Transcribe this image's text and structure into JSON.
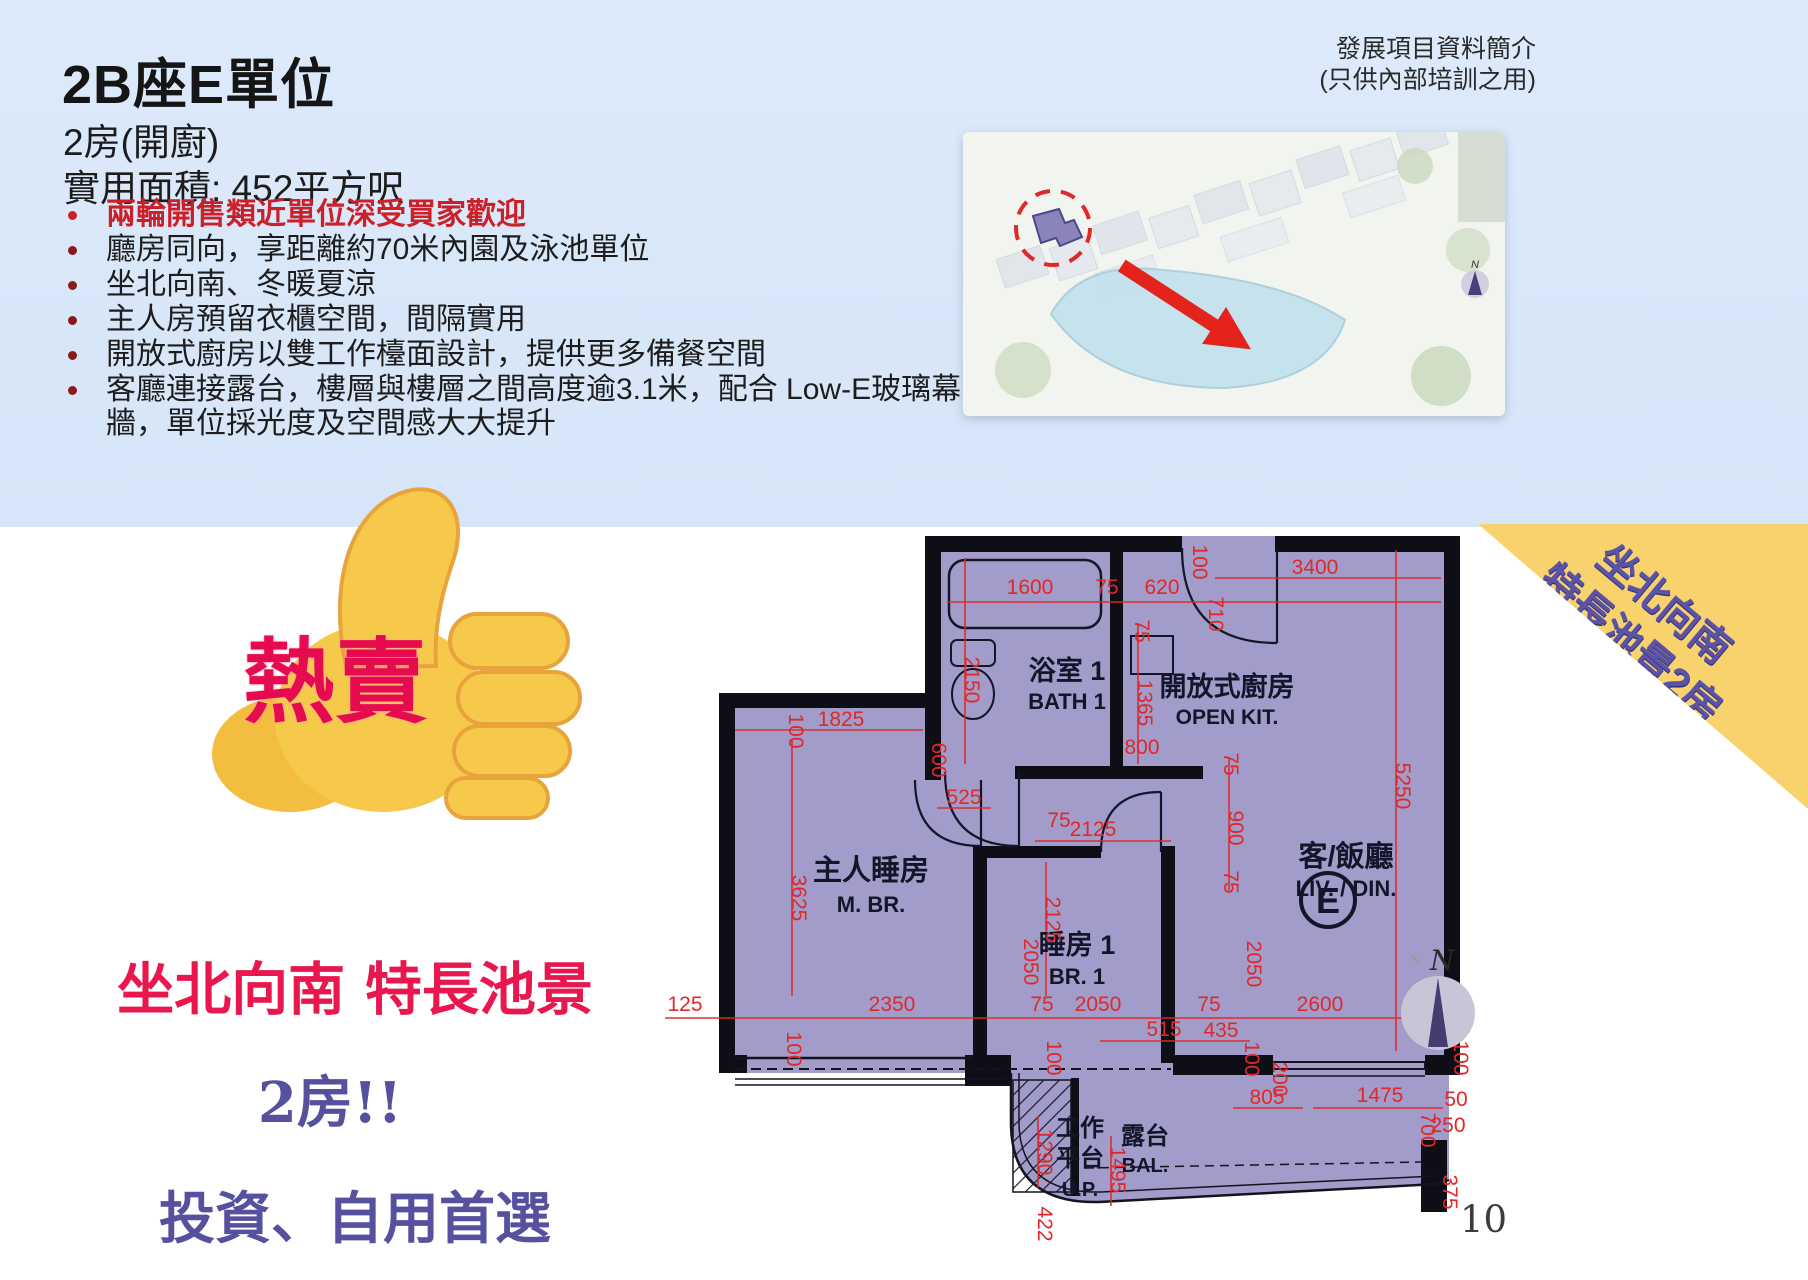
{
  "slide": {
    "title": "2B座E單位",
    "subtitle": "2房(開廚)",
    "area_line": "實用面積: 452平方呎",
    "corner_note_line1": "發展項目資料簡介",
    "corner_note_line2": "(只供內部培訓之用)",
    "page_number": "10"
  },
  "bullets": [
    {
      "text": "兩輪開售類近單位深受買家歡迎",
      "highlight": true
    },
    {
      "text": "廳房同向，享距離約70米內園及泳池單位",
      "highlight": false
    },
    {
      "text": "坐北向南、冬暖夏涼",
      "highlight": false
    },
    {
      "text": "主人房預留衣櫃空間，間隔實用",
      "highlight": false
    },
    {
      "text": "開放式廚房以雙工作檯面設計，提供更多備餐空間",
      "highlight": false
    },
    {
      "text": "客廳連接露台，樓層與樓層之間高度逾3.1米，配合 Low-E玻璃幕牆，單位採光度及空間感大大提升",
      "highlight": false
    }
  ],
  "promo": {
    "hot_sale": "熱賣",
    "line1": "坐北向南 特長池景",
    "line2": "2房!!",
    "line3": "投資、自用首選"
  },
  "banner": {
    "line1": "坐北向南",
    "line2": "特長池景2房"
  },
  "compass": {
    "north": "N"
  },
  "colors": {
    "band_blue": "#d9e7f8",
    "plan_fill": "#a19cc9",
    "wall_black": "#0e0e16",
    "dim_red": "#e02828",
    "banner_yellow": "#f8d26d",
    "banner_text": "#5b53a6",
    "promo_red": "#e8174d",
    "promo_purple": "#55519e",
    "arrow_red": "#e3231c"
  },
  "floorplan": {
    "unit_label": "E",
    "labels": [
      {
        "t": "浴室 1",
        "x": 452,
        "y": 152,
        "s": 27
      },
      {
        "t": "BATH 1",
        "x": 452,
        "y": 181,
        "s": 22
      },
      {
        "t": "開放式廚房",
        "x": 612,
        "y": 168,
        "s": 27
      },
      {
        "t": "OPEN KIT.",
        "x": 612,
        "y": 196,
        "s": 21
      },
      {
        "t": "客/飯廳",
        "x": 731,
        "y": 338,
        "s": 29
      },
      {
        "t": "LIV. / DIN.",
        "x": 731,
        "y": 368,
        "s": 22
      },
      {
        "t": "主人睡房",
        "x": 256,
        "y": 352,
        "s": 29
      },
      {
        "t": "M. BR.",
        "x": 256,
        "y": 384,
        "s": 22
      },
      {
        "t": "睡房 1",
        "x": 462,
        "y": 426,
        "s": 27
      },
      {
        "t": "BR. 1",
        "x": 462,
        "y": 456,
        "s": 22
      },
      {
        "t": "工作",
        "x": 465,
        "y": 608,
        "s": 24
      },
      {
        "t": "平台",
        "x": 465,
        "y": 638,
        "s": 24
      },
      {
        "t": "U.P.",
        "x": 465,
        "y": 668,
        "s": 20
      },
      {
        "t": "露台",
        "x": 530,
        "y": 616,
        "s": 24
      },
      {
        "t": "BAL.",
        "x": 530,
        "y": 644,
        "s": 20
      }
    ],
    "dimensions": [
      {
        "t": "1600",
        "x": 415,
        "y": 66,
        "r": 0
      },
      {
        "t": "75",
        "x": 492,
        "y": 66,
        "r": 0
      },
      {
        "t": "620",
        "x": 547,
        "y": 66,
        "r": 0
      },
      {
        "t": "3400",
        "x": 700,
        "y": 46,
        "r": 0
      },
      {
        "t": "100",
        "x": 578,
        "y": 34,
        "r": 90
      },
      {
        "t": "710",
        "x": 594,
        "y": 86,
        "r": 90
      },
      {
        "t": "2150",
        "x": 350,
        "y": 152,
        "r": 90
      },
      {
        "t": "75",
        "x": 520,
        "y": 103,
        "r": 90
      },
      {
        "t": "1365",
        "x": 523,
        "y": 175,
        "r": 90
      },
      {
        "t": "1825",
        "x": 226,
        "y": 198,
        "r": 0
      },
      {
        "t": "100",
        "x": 174,
        "y": 203,
        "r": 90
      },
      {
        "t": "600",
        "x": 317,
        "y": 232,
        "r": 90
      },
      {
        "t": "525",
        "x": 349,
        "y": 276,
        "r": 0
      },
      {
        "t": "800",
        "x": 527,
        "y": 226,
        "r": 0
      },
      {
        "t": "75",
        "x": 609,
        "y": 236,
        "r": 90
      },
      {
        "t": "900",
        "x": 614,
        "y": 300,
        "r": 90
      },
      {
        "t": "75",
        "x": 609,
        "y": 354,
        "r": 90
      },
      {
        "t": "5250",
        "x": 781,
        "y": 258,
        "r": 90
      },
      {
        "t": "2125",
        "x": 478,
        "y": 308,
        "r": 0
      },
      {
        "t": "75",
        "x": 444,
        "y": 299,
        "r": 0
      },
      {
        "t": "2125",
        "x": 431,
        "y": 392,
        "r": 90
      },
      {
        "t": "2050",
        "x": 409,
        "y": 434,
        "r": 90
      },
      {
        "t": "2050",
        "x": 632,
        "y": 436,
        "r": 90
      },
      {
        "t": "3625",
        "x": 177,
        "y": 370,
        "r": 90
      },
      {
        "t": "125",
        "x": 70,
        "y": 483,
        "r": 0
      },
      {
        "t": "2350",
        "x": 277,
        "y": 483,
        "r": 0
      },
      {
        "t": "75",
        "x": 427,
        "y": 483,
        "r": 0
      },
      {
        "t": "2050",
        "x": 483,
        "y": 483,
        "r": 0
      },
      {
        "t": "75",
        "x": 594,
        "y": 483,
        "r": 0
      },
      {
        "t": "2600",
        "x": 705,
        "y": 483,
        "r": 0
      },
      {
        "t": "125",
        "x": 815,
        "y": 483,
        "r": 0
      },
      {
        "t": "515",
        "x": 549,
        "y": 508,
        "r": 0
      },
      {
        "t": "435",
        "x": 606,
        "y": 509,
        "r": 0
      },
      {
        "t": "100",
        "x": 630,
        "y": 531,
        "r": 90
      },
      {
        "t": "200",
        "x": 658,
        "y": 551,
        "r": 90
      },
      {
        "t": "100",
        "x": 172,
        "y": 521,
        "r": 90
      },
      {
        "t": "100",
        "x": 432,
        "y": 530,
        "r": 90
      },
      {
        "t": "100",
        "x": 839,
        "y": 530,
        "r": 90
      },
      {
        "t": "805",
        "x": 652,
        "y": 576,
        "r": 0
      },
      {
        "t": "1475",
        "x": 765,
        "y": 574,
        "r": 0
      },
      {
        "t": "50",
        "x": 841,
        "y": 578,
        "r": 0
      },
      {
        "t": "700",
        "x": 806,
        "y": 602,
        "r": 90
      },
      {
        "t": "250",
        "x": 833,
        "y": 604,
        "r": 0
      },
      {
        "t": "1495",
        "x": 496,
        "y": 642,
        "r": 90
      },
      {
        "t": "1290",
        "x": 423,
        "y": 624,
        "r": 90
      },
      {
        "t": "422",
        "x": 423,
        "y": 696,
        "r": 90
      },
      {
        "t": "375",
        "x": 828,
        "y": 664,
        "r": 90
      }
    ]
  }
}
